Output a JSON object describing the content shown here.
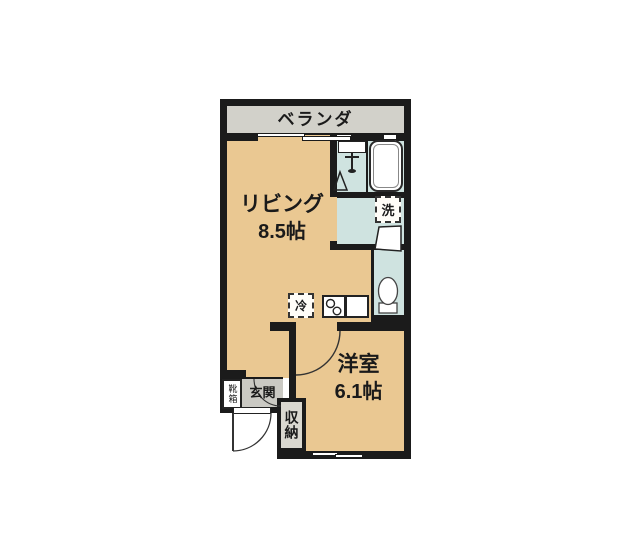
{
  "floor_plan": {
    "rooms": {
      "veranda": {
        "label": "ベランダ"
      },
      "living": {
        "label": "リビング",
        "size": "8.5帖"
      },
      "western_room": {
        "label": "洋室",
        "size": "6.1帖"
      },
      "entrance": {
        "label": "玄関"
      }
    },
    "fixtures": {
      "washing_machine": {
        "label": "洗"
      },
      "refrigerator": {
        "label": "冷"
      },
      "shoe_box": {
        "label": "靴箱"
      },
      "storage": {
        "label": "収納"
      }
    },
    "colors": {
      "wall": "#1b1b1b",
      "room_tan": "#eac892",
      "wet_area_blue": "#cfe3e0",
      "veranda_gray": "#d2d1ca",
      "entrance_gray": "#cac9c3",
      "storage_gray": "#dad8d0"
    }
  }
}
